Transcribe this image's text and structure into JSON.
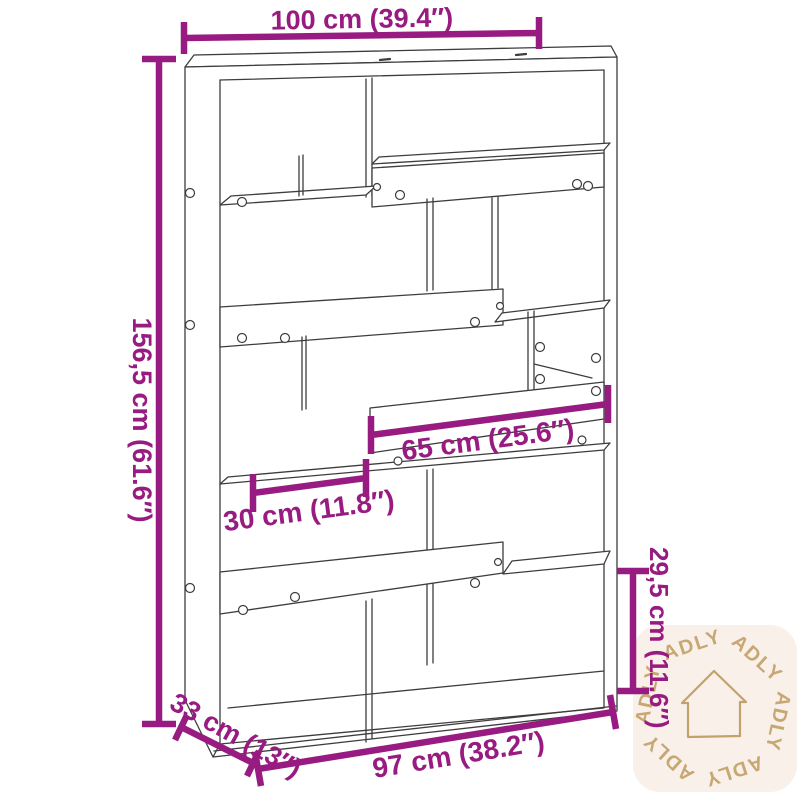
{
  "title": "Bookshelf dimension diagram",
  "diagram": {
    "type": "furniture-dimension-line-drawing",
    "subject": "staggered open bookshelf / room divider",
    "dimensions": {
      "top_width": "100 cm (39.4″)",
      "height": "156,5 cm (61.6″)",
      "middle_width": "65 cm (25.6″)",
      "left_inner_width": "30 cm (11.8″)",
      "right_inner_height": "29,5 cm (11.6″)",
      "depth": "33 cm (13″)",
      "bottom_width": "97 cm (38.2″)"
    },
    "colors": {
      "dimension_accent": "#971b80",
      "drawing_line": "#3d3d3d",
      "watermark_gold": "#c3a26a",
      "watermark_background": "#faf0ea",
      "page_background": "#ffffff"
    }
  },
  "watermark": {
    "brand": "ADLY",
    "icon": "house-outline"
  }
}
